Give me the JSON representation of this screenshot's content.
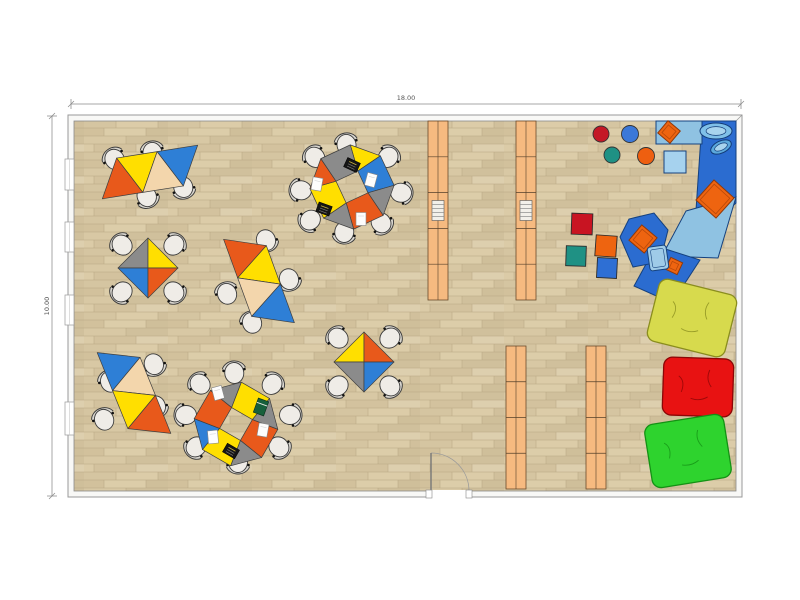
{
  "dimensions": {
    "width_label": "18.00",
    "height_label": "10.00"
  },
  "colors": {
    "table_orange": "#e8591b",
    "table_yellow": "#ffdf00",
    "table_blue": "#2e7fd6",
    "table_tan": "#f3d6ac",
    "table_gray": "#8b8b8b",
    "floor_base": "#d6c6a4",
    "floor_seam": "#b7a682",
    "wall_fill": "#f8f8f6",
    "wall_stroke": "#999999",
    "shelf_fill": "#f6ba80",
    "shelf_stroke": "#6b4a2a",
    "soft_dark": "#2b6cd0",
    "soft_light": "#8fc2e2",
    "soft_stroke": "#15417e",
    "cushion_orange": "#ee6410",
    "chair_seat": "#efece7",
    "chair_stroke": "#3c3c3c"
  },
  "plan": {
    "room": {
      "outer": [
        68,
        115,
        674,
        382
      ],
      "floor": [
        74,
        121,
        662,
        370
      ]
    },
    "windows": [
      [
        65,
        159,
        9,
        31
      ],
      [
        65,
        222,
        9,
        30
      ],
      [
        65,
        295,
        9,
        30
      ],
      [
        65,
        402,
        9,
        33
      ]
    ],
    "door": {
      "gap": [
        428,
        490,
        42,
        8
      ],
      "hinge_x": 431,
      "wall_y": 491,
      "leaf_top_y": 453,
      "radius": 38
    },
    "shelves": [
      {
        "x": 428,
        "y": 121,
        "w": 20,
        "h": 179,
        "rows": 5,
        "book": true
      },
      {
        "x": 516,
        "y": 121,
        "w": 20,
        "h": 179,
        "rows": 5,
        "book": true
      },
      {
        "x": 506,
        "y": 346,
        "w": 20,
        "h": 143,
        "rows": 4,
        "book": false
      },
      {
        "x": 586,
        "y": 346,
        "w": 20,
        "h": 143,
        "rows": 4,
        "book": false
      }
    ],
    "strip_tables": [
      {
        "cx": 150,
        "cy": 172,
        "rot": -9,
        "colors": [
          "orange",
          "yellow",
          "tan",
          "blue"
        ],
        "chairs": [
          [
            113,
            157,
            325
          ],
          [
            152,
            150,
            350
          ],
          [
            148,
            199,
            155
          ],
          [
            184,
            190,
            165
          ]
        ]
      },
      {
        "cx": 259,
        "cy": 281,
        "rot": 70,
        "colors": [
          "orange",
          "yellow",
          "tan",
          "blue"
        ],
        "chairs": [
          [
            267,
            243,
            160
          ],
          [
            290,
            282,
            160
          ],
          [
            226,
            291,
            340
          ],
          [
            251,
            320,
            340
          ]
        ]
      },
      {
        "cx": 134,
        "cy": 393,
        "rot": 68,
        "colors": [
          "blue",
          "tan",
          "yellow",
          "orange"
        ],
        "chairs": [
          [
            155,
            367,
            158
          ],
          [
            157,
            409,
            158
          ],
          [
            109,
            379,
            338
          ],
          [
            103,
            417,
            338
          ]
        ]
      }
    ],
    "octagon_tables": [
      {
        "cx": 352,
        "cy": 187,
        "rot": 20,
        "pieces": [
          "yellow",
          "blue",
          "gray",
          "orange",
          "gray",
          "yellow",
          "orange",
          "gray"
        ],
        "chairs": [
          [
            346,
            142,
            350
          ],
          [
            390,
            155,
            40
          ],
          [
            404,
            193,
            95
          ],
          [
            383,
            225,
            140
          ],
          [
            344,
            235,
            185
          ],
          [
            308,
            222,
            230
          ],
          [
            298,
            190,
            275
          ],
          [
            313,
            155,
            320
          ]
        ],
        "items": [
          {
            "t": "laptop",
            "x": 352,
            "y": 165,
            "r": 25
          },
          {
            "t": "paper",
            "x": 371,
            "y": 180,
            "r": 15
          },
          {
            "t": "paper",
            "x": 361,
            "y": 219,
            "r": 0
          },
          {
            "t": "laptop",
            "x": 324,
            "y": 209,
            "r": 20
          },
          {
            "t": "paper",
            "x": 317,
            "y": 184,
            "r": 10
          }
        ]
      },
      {
        "cx": 236,
        "cy": 424,
        "rot": -15,
        "pieces": [
          "gray",
          "yellow",
          "gray",
          "orange",
          "gray",
          "yellow",
          "blue",
          "orange"
        ],
        "chairs": [
          [
            234,
            370,
            355
          ],
          [
            274,
            382,
            40
          ],
          [
            293,
            415,
            90
          ],
          [
            281,
            449,
            135
          ],
          [
            238,
            465,
            180
          ],
          [
            194,
            449,
            225
          ],
          [
            183,
            415,
            270
          ],
          [
            198,
            382,
            315
          ]
        ],
        "items": [
          {
            "t": "paper",
            "x": 218,
            "y": 393,
            "r": -15
          },
          {
            "t": "book",
            "x": 261,
            "y": 407,
            "r": 20
          },
          {
            "t": "paper",
            "x": 263,
            "y": 430,
            "r": 10
          },
          {
            "t": "paper",
            "x": 213,
            "y": 437,
            "r": -5
          },
          {
            "t": "laptop",
            "x": 231,
            "y": 451,
            "r": 30
          }
        ]
      }
    ],
    "cross_tables": [
      {
        "cx": 148,
        "cy": 268,
        "quads": [
          "gray",
          "yellow",
          "blue",
          "orange"
        ],
        "chairs": [
          [
            120,
            243,
            315
          ],
          [
            176,
            243,
            45
          ],
          [
            176,
            294,
            135
          ],
          [
            120,
            294,
            225
          ]
        ]
      },
      {
        "cx": 364,
        "cy": 362,
        "quads": [
          "yellow",
          "orange",
          "gray",
          "blue"
        ],
        "chairs": [
          [
            336,
            336,
            315
          ],
          [
            392,
            336,
            45
          ],
          [
            392,
            388,
            135
          ],
          [
            336,
            388,
            225
          ]
        ]
      }
    ],
    "stools": [
      {
        "cx": 601,
        "cy": 134,
        "r": 8,
        "color": "#c41826"
      },
      {
        "cx": 630,
        "cy": 134,
        "r": 8.5,
        "color": "#3b78d8"
      },
      {
        "cx": 612,
        "cy": 155,
        "r": 8,
        "color": "#1f9184"
      },
      {
        "cx": 646,
        "cy": 156,
        "r": 8.5,
        "color": "#ee5f10"
      }
    ],
    "floor_cushions": [
      {
        "cx": 582,
        "cy": 224,
        "s": 21,
        "rot": 2,
        "color": "#c81422"
      },
      {
        "cx": 606,
        "cy": 246,
        "s": 21,
        "rot": 4,
        "color": "#ee6410"
      },
      {
        "cx": 576,
        "cy": 256,
        "s": 20,
        "rot": 2,
        "color": "#1f9184"
      },
      {
        "cx": 607,
        "cy": 268,
        "s": 20,
        "rot": 3,
        "color": "#2e6fd4"
      }
    ],
    "bean_bags": [
      {
        "cx": 692,
        "cy": 318,
        "w": 80,
        "h": 64,
        "rot": 14,
        "color": "#d7da4d",
        "edge": "#8a8d1e"
      },
      {
        "cx": 698,
        "cy": 387,
        "w": 70,
        "h": 58,
        "rot": 2,
        "color": "#e81212",
        "edge": "#8c0606"
      },
      {
        "cx": 688,
        "cy": 451,
        "w": 80,
        "h": 64,
        "rot": -9,
        "color": "#2ed32e",
        "edge": "#149114"
      }
    ],
    "soft_corner": {
      "bench": [
        656,
        121,
        46,
        23
      ],
      "polys": [
        {
          "pts": [
            [
              702,
              121
            ],
            [
              736,
              121
            ],
            [
              736,
              203
            ],
            [
              694,
              240
            ]
          ],
          "tone": "dark"
        },
        {
          "pts": [
            [
              686,
              211
            ],
            [
              736,
              197
            ],
            [
              718,
              258
            ],
            [
              662,
              256
            ]
          ],
          "tone": "light"
        },
        {
          "pts": [
            [
              656,
              246
            ],
            [
              700,
              260
            ],
            [
              672,
              303
            ],
            [
              634,
              286
            ]
          ],
          "tone": "dark"
        },
        {
          "pts": [
            [
              620,
              237
            ],
            [
              629,
              219
            ],
            [
              654,
              213
            ],
            [
              668,
              230
            ],
            [
              660,
              262
            ],
            [
              633,
              267
            ]
          ],
          "tone": "dark"
        }
      ],
      "light_square": [
        664,
        151,
        22,
        22
      ],
      "bowls": [
        {
          "cx": 716,
          "cy": 131,
          "rx": 16,
          "ry": 8,
          "rot": 0
        },
        {
          "cx": 721,
          "cy": 147,
          "rx": 11,
          "ry": 6,
          "rot": -25
        }
      ],
      "orange_cushions": [
        {
          "cx": 669,
          "cy": 132,
          "s": 16,
          "rot": 40
        },
        {
          "cx": 715,
          "cy": 199,
          "s": 27,
          "rot": 42
        },
        {
          "cx": 643,
          "cy": 239,
          "s": 20,
          "rot": 40
        },
        {
          "cx": 674,
          "cy": 266,
          "s": 13,
          "rot": 25
        }
      ],
      "light_pillow": {
        "cx": 658,
        "cy": 258,
        "w": 19,
        "h": 24,
        "rot": -8
      }
    }
  }
}
